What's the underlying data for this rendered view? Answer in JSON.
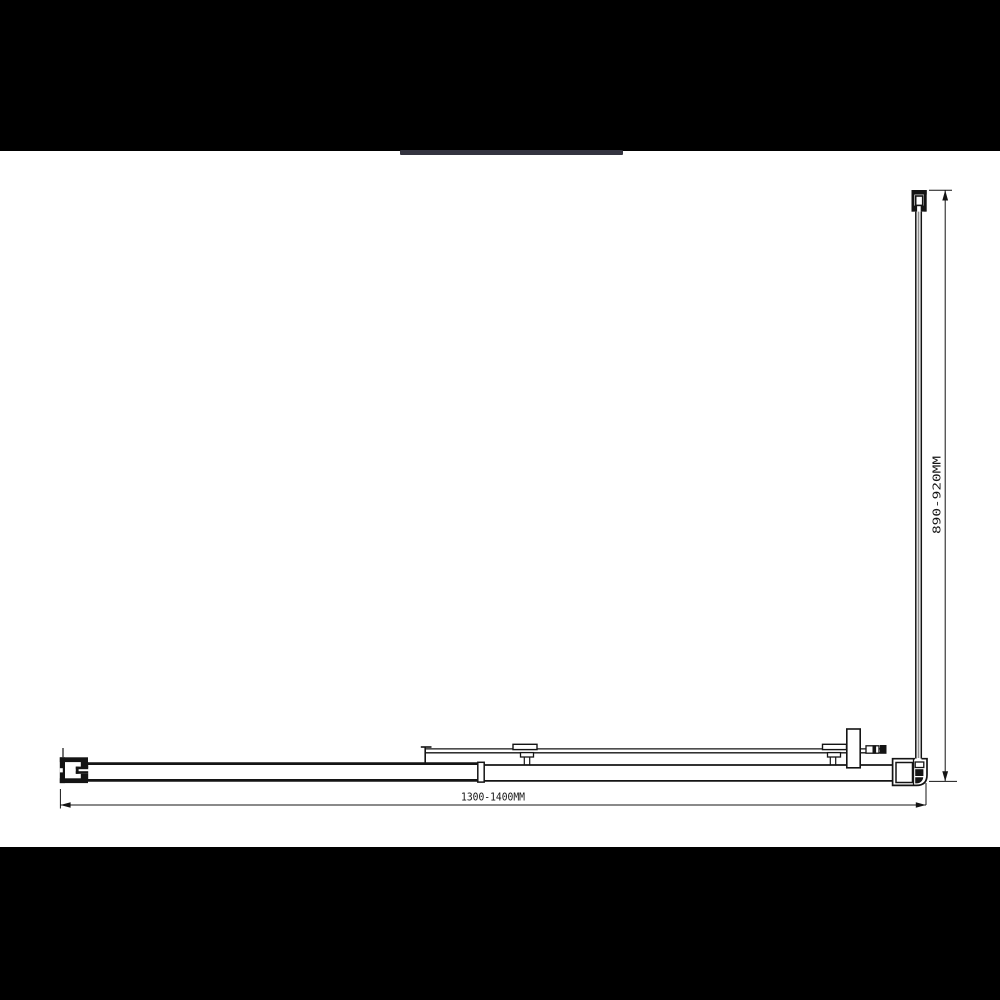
{
  "drawing": {
    "labels": {
      "width": "1300-1400MM",
      "depth": "890-920MM"
    },
    "colors": {
      "line": "#141414",
      "background": "#ffffff",
      "matte": "#000000",
      "accent_bar": "#343440",
      "glass_core": "#8e8e8e"
    }
  }
}
